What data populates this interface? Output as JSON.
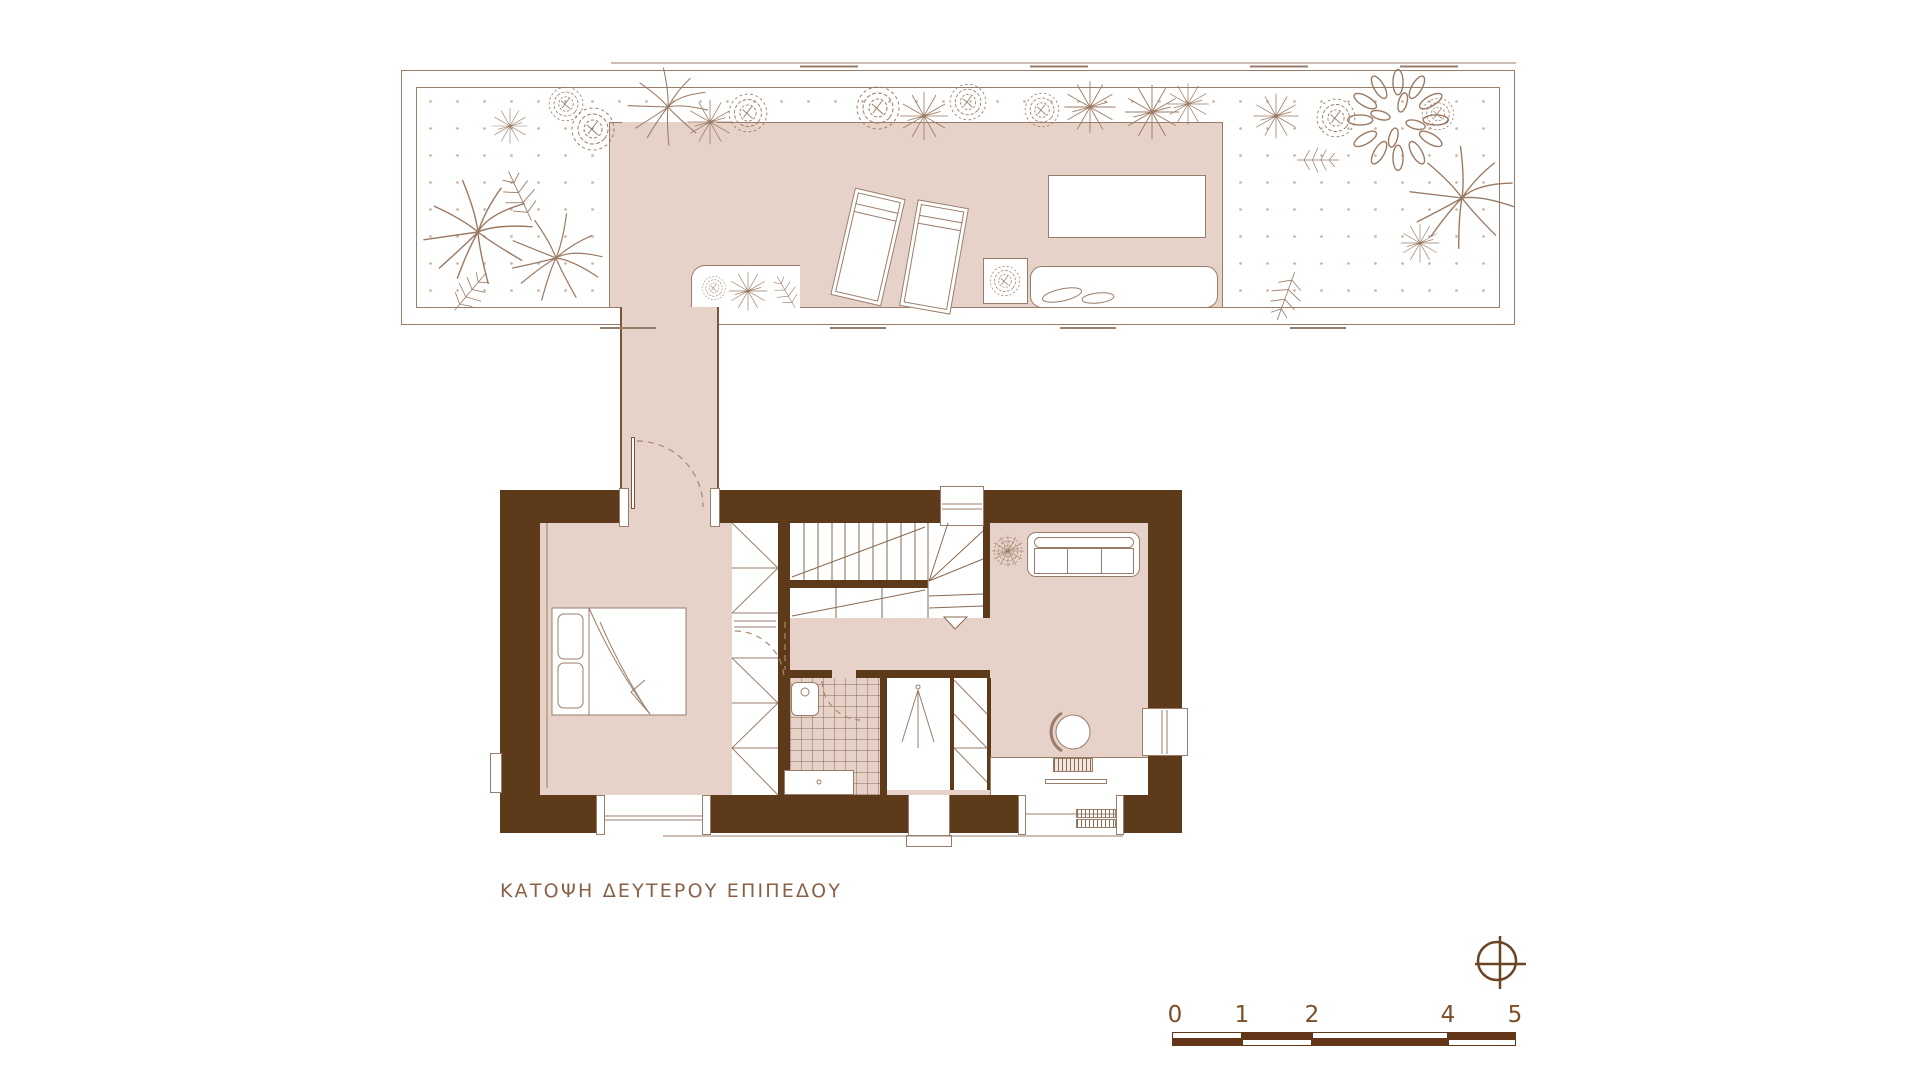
{
  "title": {
    "text": "ΚΑΤΟΨΗ ΔΕΥΤΕΡΟΥ ΕΠΙΠΕΔΟΥ"
  },
  "scale_bar": {
    "labels": [
      "0",
      "1",
      "2",
      "4",
      "5"
    ]
  },
  "north_indicator": {
    "icon": "circle-cross-icon"
  },
  "colors": {
    "wall": "#5c3a1a",
    "floor_deck": "#e6d2c8",
    "drawing_line": "#9a7d68",
    "title_text": "#8a6148",
    "scale_text": "#7c4f28",
    "scale_fill": "#63361a",
    "background": "#ffffff"
  }
}
